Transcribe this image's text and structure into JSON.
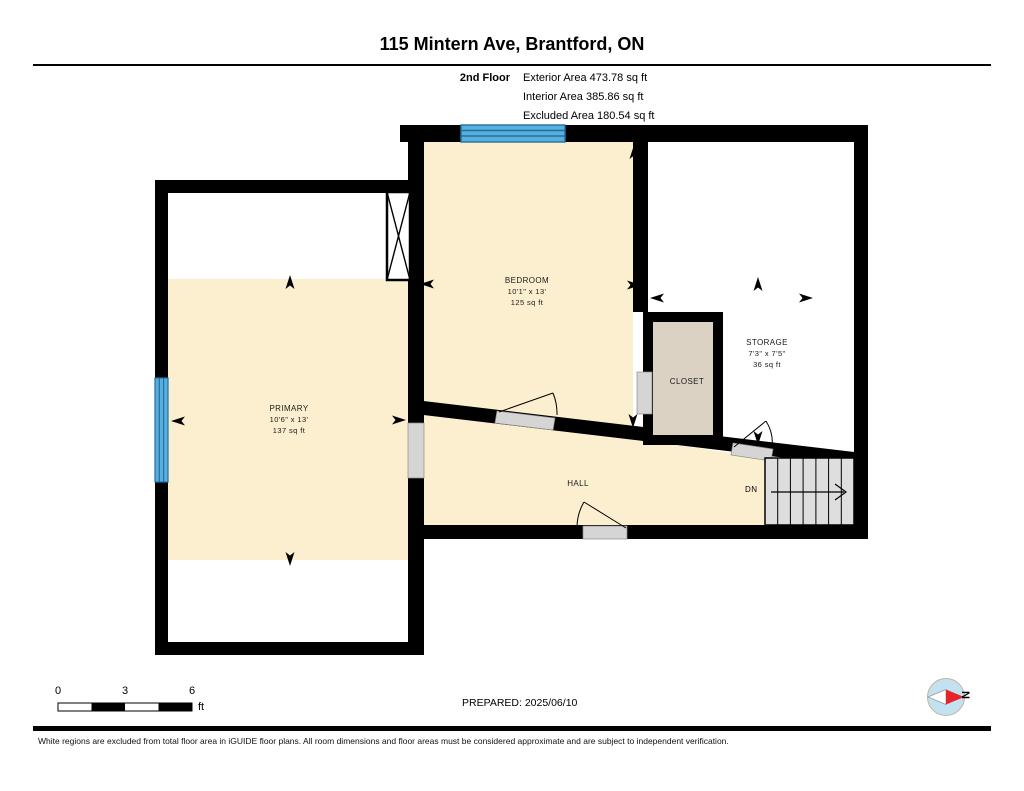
{
  "header": {
    "title": "115 Mintern Ave, Brantford, ON",
    "floor_label": "2nd Floor",
    "stats": [
      "Exterior Area 473.78 sq ft",
      "Interior Area 385.86 sq ft",
      "Excluded Area 180.54 sq ft"
    ]
  },
  "rooms": {
    "primary": {
      "name": "PRIMARY",
      "dims": "10'6\" x 13'",
      "area": "137 sq ft"
    },
    "bedroom": {
      "name": "BEDROOM",
      "dims": "10'1\" x 13'",
      "area": "125 sq ft"
    },
    "storage": {
      "name": "STORAGE",
      "dims": "7'3\" x 7'5\"",
      "area": "36 sq ft"
    },
    "closet": {
      "name": "CLOSET"
    },
    "hall": {
      "name": "HALL"
    }
  },
  "stairs": {
    "label": "DN"
  },
  "scale_bar": {
    "ticks": [
      "0",
      "3",
      "6"
    ],
    "unit": "ft"
  },
  "prepared_label": "PREPARED: 2025/06/10",
  "compass": {
    "north_label": "N"
  },
  "footer": {
    "disclaimer": "White regions are excluded from total floor area in iGUIDE floor plans. All room dimensions and floor areas must be considered approximate and are subject to independent verification."
  },
  "colors": {
    "wall_black": "#000000",
    "room_fill": "#FBEFCF",
    "closet_fill": "#DCD2C3",
    "window_blue": "#58AEDC",
    "window_line": "#20719F",
    "door_gray": "#D5D5D5",
    "stairs_gray": "#DEDEDE",
    "compass_blue": "#C2E2F2",
    "compass_red": "#E8242B"
  }
}
